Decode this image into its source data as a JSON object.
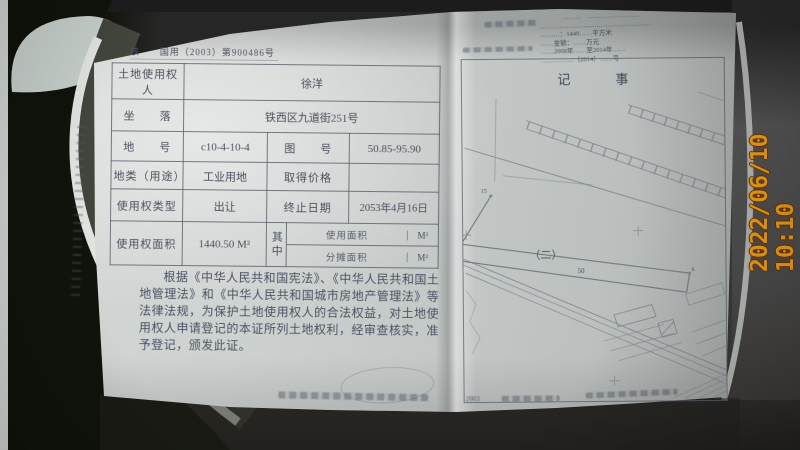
{
  "camera": {
    "timestamp": "2022/06/10 10:10",
    "timestamp_color": "#f1a31c"
  },
  "certificate": {
    "serial_line": "核　　国用（2003）第900486号",
    "table": {
      "holder_label": "土地使用权人",
      "holder_value": "徐洋",
      "location_label": "坐　　落",
      "location_value": "铁西区九道街251号",
      "parcel_no_label": "地　　号",
      "parcel_no_value": "c10-4-10-4",
      "sheet_no_label": "图　　号",
      "sheet_no_value": "50.85-95.90",
      "land_use_label": "地类（用途）",
      "land_use_value": "工业用地",
      "price_label": "取得价格",
      "price_value": "",
      "tenure_label": "使用权类型",
      "tenure_value": "出让",
      "expiry_label": "终止日期",
      "expiry_value": "2053年4月16日",
      "area_label": "使用权面积",
      "area_value": "1440.50 M²",
      "among_label": "其中",
      "use_area_label": "使用面积",
      "use_area_unit": "M²",
      "shared_area_label": "分摊面积",
      "shared_area_unit": "M²"
    },
    "declaration": "根据《中华人民共和国宪法》、《中华人民共和国土地管理法》和《中华人民共和国城市房地产管理法》等法律法规，为保护土地使用权人的合法权益，对土地使用权人申请登记的本证所列土地权利，经审查核实，准予登记，颁发此证。"
  },
  "notes_page": {
    "title": "记　事",
    "stamp_note_lines": [
      "………　……………………",
      "……………………………………………",
      "………：1440……平方米",
      "……金额：……万元",
      "……2008年……至2014年……",
      "……………（2014）……号"
    ],
    "map": {
      "section_label": "（二）",
      "plot_number": "50",
      "vertex_label_left": "15",
      "vertex_label_right": "6"
    },
    "footer_year": "2003"
  }
}
